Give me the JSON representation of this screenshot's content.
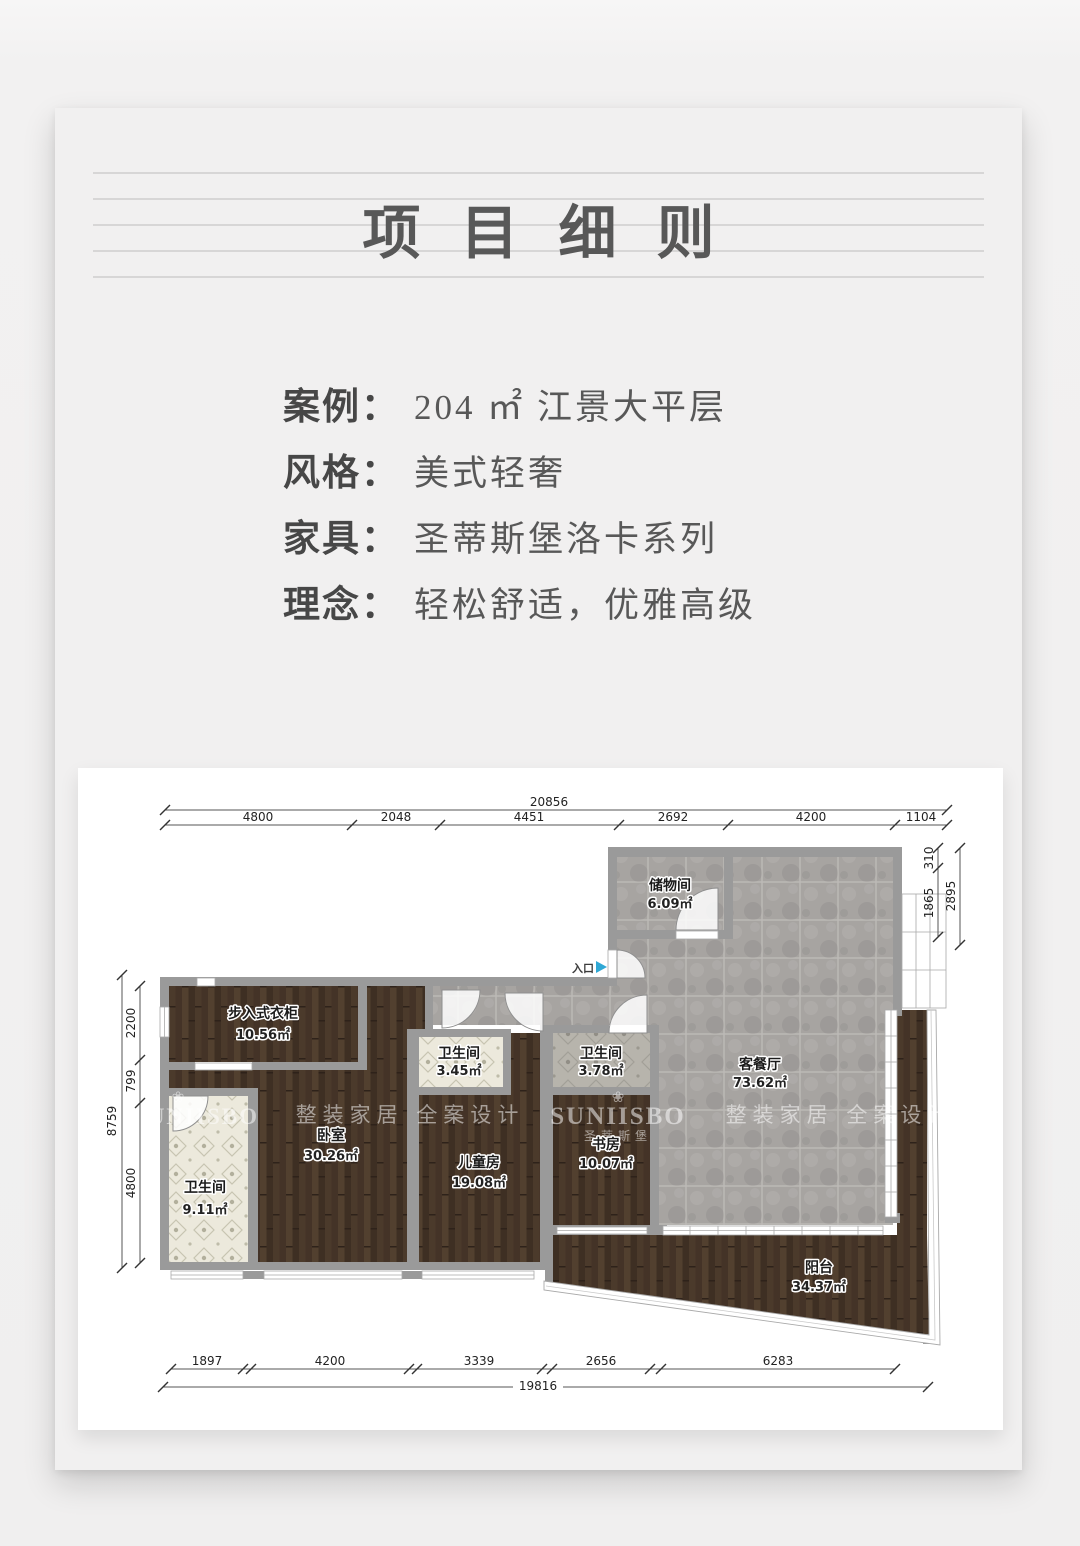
{
  "page": {
    "title": "项目细则"
  },
  "info": {
    "rows": [
      {
        "label": "案例：",
        "value": "204 ㎡ 江景大平层"
      },
      {
        "label": "风格：",
        "value": "美式轻奢"
      },
      {
        "label": "家具：",
        "value": "圣蒂斯堡洛卡系列"
      },
      {
        "label": "理念：",
        "value": "轻松舒适，优雅高级"
      }
    ]
  },
  "floorplan": {
    "entry_label": "入口",
    "watermark_text": "整装家居 全案设计",
    "brand": "SUNIISBO",
    "brand_cn": "圣蒂斯堡",
    "flower": "❀",
    "rooms": {
      "storage": {
        "name": "储物间",
        "area": "6.09㎡"
      },
      "closet": {
        "name": "步入式衣柜",
        "area": "10.56㎡"
      },
      "bedroom": {
        "name": "卧室",
        "area": "30.26㎡"
      },
      "bath_master": {
        "name": "卫生间",
        "area": "9.11㎡"
      },
      "bath_small": {
        "name": "卫生间",
        "area": "3.45㎡"
      },
      "bath_guest": {
        "name": "卫生间",
        "area": "3.78㎡"
      },
      "kids": {
        "name": "儿童房",
        "area": "19.08㎡"
      },
      "study": {
        "name": "书房",
        "area": "10.07㎡"
      },
      "living": {
        "name": "客餐厅",
        "area": "73.62㎡"
      },
      "balcony": {
        "name": "阳台",
        "area": "34.37㎡"
      }
    },
    "dims": {
      "top_total": "20856",
      "top": [
        "4800",
        "2048",
        "4451",
        "2692",
        "4200",
        "1104"
      ],
      "bottom": [
        "1897",
        "4200",
        "3339",
        "2656",
        "6283"
      ],
      "bottom_total": "19816",
      "left_total": "8759",
      "left": [
        "2200",
        "799",
        "4800"
      ],
      "right": [
        "310",
        "1865"
      ],
      "right_total": "2895"
    },
    "colors": {
      "accent_arrow": "#2fa8d5",
      "wall": "#9a9a9a",
      "wood": "#46362a",
      "stone": "#a7a4a1",
      "bath_tile": "#ebe9dc"
    }
  }
}
